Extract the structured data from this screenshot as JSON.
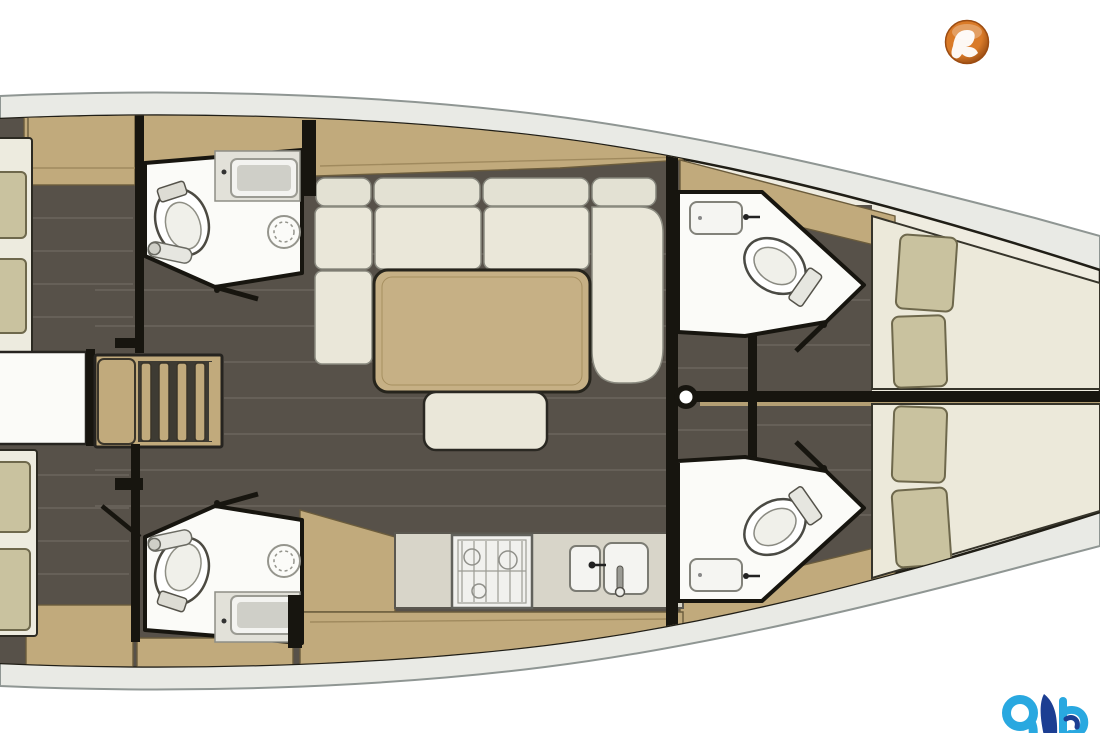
{
  "canvas": {
    "width": 1100,
    "height": 733
  },
  "palette": {
    "page_bg": "#ffffff",
    "hull_band": "#e9eae5",
    "hull_edge": "#8f9693",
    "hull_inner_line": "#201e16",
    "interior": "#efece0",
    "floor": "#575149",
    "floor_seam": "#6f6961",
    "wood": "#c1aa7c",
    "wood_edge": "#6b5c3c",
    "wood_seam": "#a08a5e",
    "wall": "#17150f",
    "cushion": "#c9c29f",
    "cushion_edge": "#6e684c",
    "mattress": "#edebdf",
    "fwd_mattress": "#ece9da",
    "sofa": "#eae7d9",
    "sofa_back": "#e3e1d3",
    "table_wood": "#c6b085",
    "counter": "#d8d5c9",
    "fixture": "#fbfbf8",
    "steps_gap": "#3e3b33",
    "centerline_wood": "#b49f74",
    "white": "#ffffff"
  },
  "logos": {
    "top_right": {
      "icon": "orange-globe-bird-badge-icon",
      "colors": {
        "base": "#d97a28",
        "deep": "#873f0c",
        "rim": "#9c4c12",
        "glyph": "#ffffff"
      }
    },
    "bottom_right": {
      "icon": "blue-yb-monogram-icon",
      "colors": {
        "light": "#29a8e0",
        "dark": "#1c3e92"
      }
    }
  }
}
